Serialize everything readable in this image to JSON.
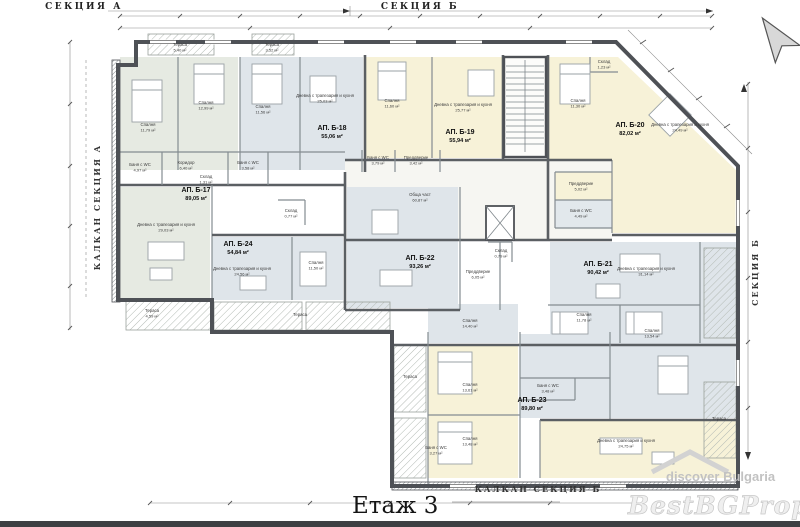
{
  "title": "Етаж 3",
  "sections": {
    "top_left": "СЕКЦИЯ А",
    "top_center": "СЕКЦИЯ Б",
    "left_vertical": "КАЛКАН СЕКЦИЯ А",
    "right_vertical": "СЕКЦИЯ Б",
    "bottom": "КАЛКАН СЕКЦИЯ Б"
  },
  "apartments": [
    {
      "id": "АП. Б-17",
      "area": "89,05 м²"
    },
    {
      "id": "АП. Б-18",
      "area": "55,06 м²"
    },
    {
      "id": "АП. Б-19",
      "area": "55,94 м²"
    },
    {
      "id": "АП. Б-20",
      "area": "82,02 м²"
    },
    {
      "id": "АП. Б-21",
      "area": "90,42 м²"
    },
    {
      "id": "АП. Б-22",
      "area": "93,26 м²"
    },
    {
      "id": "АП. Б-23",
      "area": "89,80 м²"
    },
    {
      "id": "АП. Б-24",
      "area": "54,84 м²"
    }
  ],
  "room_labels": [
    {
      "name": "Спалня",
      "area": "11,79 м²"
    },
    {
      "name": "Спалня",
      "area": "12,99 м²"
    },
    {
      "name": "Спалня",
      "area": "11,56 м²"
    },
    {
      "name": "Дневна с трапезария и кухня",
      "area": "25,03 м²"
    },
    {
      "name": "Спалня",
      "area": "11,60 м²"
    },
    {
      "name": "Дневна с трапезария и кухня",
      "area": "25,77 м²"
    },
    {
      "name": "Спалня",
      "area": "11,30 м²"
    },
    {
      "name": "Дневна с трапезария и кухня",
      "area": "24,49 м²"
    },
    {
      "name": "Дневна с трапезария и кухня",
      "area": "29,03 м²"
    },
    {
      "name": "Дневна с трапезария и кухня",
      "area": "24,56 м²"
    },
    {
      "name": "Спалня",
      "area": "11,50 м²"
    },
    {
      "name": "Дневна с трапезария и кухня",
      "area": "31,14 м²"
    },
    {
      "name": "Спалня",
      "area": "14,40 м²"
    },
    {
      "name": "Спалня",
      "area": "11,78 м²"
    },
    {
      "name": "Спалня",
      "area": "13,54 м²"
    },
    {
      "name": "Спалня",
      "area": "13,61 м²"
    },
    {
      "name": "Спалня",
      "area": "13,48 м²"
    },
    {
      "name": "Дневна с трапезария и кухня",
      "area": "24,75 м²"
    },
    {
      "name": "Баня с WC",
      "area": "4,97 м²"
    },
    {
      "name": "Баня с WC",
      "area": "3,58 м²"
    },
    {
      "name": "Баня с WC",
      "area": "3,79 м²"
    },
    {
      "name": "Баня с WC",
      "area": "4,49 м²"
    },
    {
      "name": "Баня с WC",
      "area": "3,48 м²"
    },
    {
      "name": "Баня с WC",
      "area": "3,27 м²"
    },
    {
      "name": "Коридор",
      "area": "6,40 м²"
    },
    {
      "name": "Склад",
      "area": "1,31 м²"
    },
    {
      "name": "Преддверие",
      "area": "3,42 м²"
    },
    {
      "name": "Преддверие",
      "area": "5,02 м²"
    },
    {
      "name": "Преддверие",
      "area": "6,05 м²"
    },
    {
      "name": "Склад",
      "area": "0,79 м²"
    },
    {
      "name": "Склад",
      "area": "1,23 м²"
    },
    {
      "name": "Склад",
      "area": "0,77 м²"
    },
    {
      "name": "Обща част",
      "area": "60,87 м²"
    },
    {
      "name": "Тераса",
      "area": "5,40 м²"
    },
    {
      "name": "Тераса",
      "area": "3,52 м²"
    },
    {
      "name": "Тераса",
      "area": "4,59 м²"
    },
    {
      "name": "Тераса",
      "area": ""
    },
    {
      "name": "Тераса",
      "area": ""
    },
    {
      "name": "Тераса",
      "area": ""
    }
  ],
  "watermarks": {
    "small": "discover Bulgaria",
    "large": "BestBGProperties"
  },
  "colors": {
    "wall": "#4e5156",
    "room_green": "#e6eae2",
    "room_blue": "#dfe5ea",
    "room_yellow": "#f7f2d8",
    "corridor": "#f6f6f2",
    "hatch": "#b3bab4",
    "watermark": "#c8c8c8"
  }
}
